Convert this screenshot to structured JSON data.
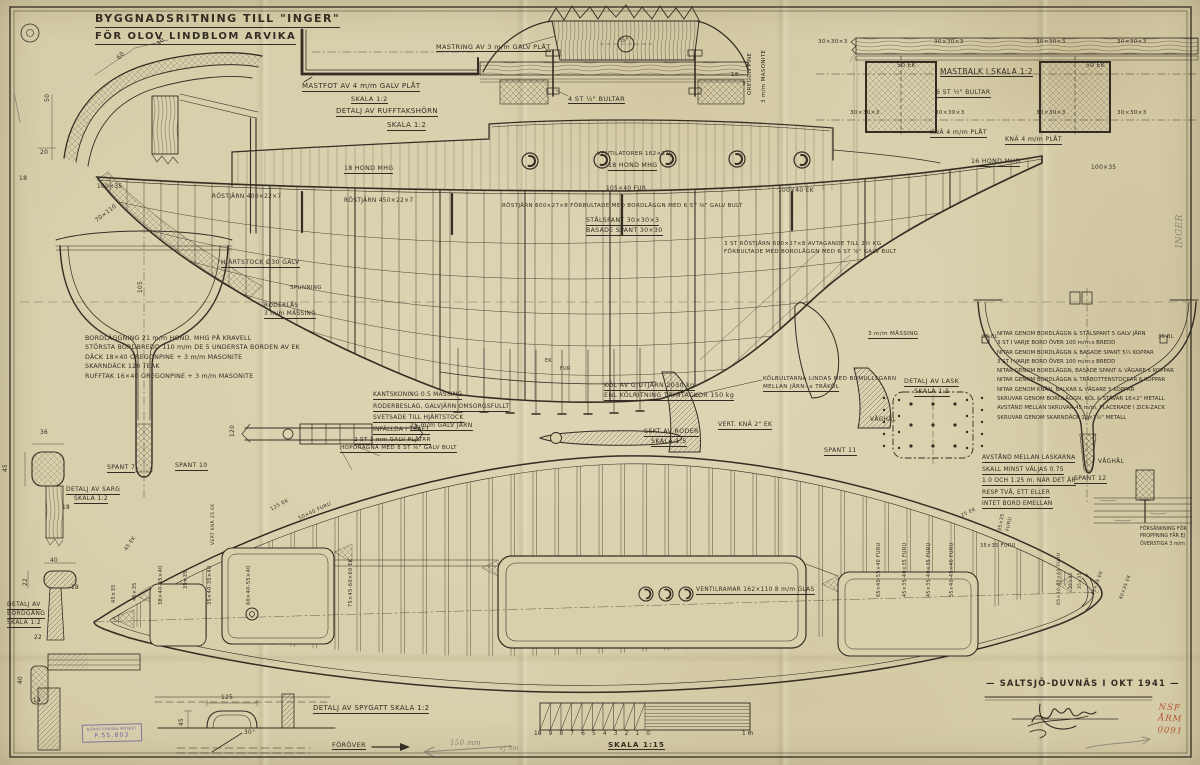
{
  "colors": {
    "paper": "#d6cda9",
    "ink": "#332d23",
    "pencil": "#8b8374",
    "stamp_purple": "#6f5b9e",
    "archive_red": "#b5502f"
  },
  "title": {
    "line1": "BYGGNADSRITNING TILL \"INGER\"",
    "line2": "FÖR OLOV LINDBLOM  ARVIKA"
  },
  "signature": {
    "place_date": "— SALTSJÖ-DUVNÄS I OKT 1941 —"
  },
  "scale_bar": {
    "numbers": [
      "10",
      "9",
      "8",
      "7",
      "6",
      "5",
      "4",
      "3",
      "2",
      "1",
      "0"
    ],
    "end_label": "1 m",
    "caption": "SKALA 1:15"
  },
  "stamps": {
    "museum_line1": "SJÖHISTORISKA MUSEET",
    "museum_line2": "P.55.803",
    "archive": [
      "NSF",
      "ÅRM",
      "0091"
    ]
  },
  "text_blocks": {
    "spec": [
      "BORDLÄGGNING   21 m/m HOND. MHG PÅ KRAVELL",
      "STÖRSTA BORDBREDD  110 m/m  DE 5 UNDERSTA BORDEN AV EK",
      "DÄCK  18×40 OREGONPINE + 3 m/m MASONITE",
      "SKARNDÄCK  120 TEAK",
      "RUFFTAK  16×40 OREGONPINE + 3 m/m MASONITE"
    ],
    "kantskoning": [
      "KANTSKONING 0.5 MÄSSING",
      "RODERBESLAG, GALVJÄRN OMSORGSFULLT",
      "SVETSADE TILL HJÄRTSTOCK",
      "INFÄLLDA I TRÄET"
    ],
    "nitar": [
      "NITAR GENOM BORDLÄGGN & STÅLSPANT  5 GALV JÄRN",
      "3 ST I VARJE BORD ÖVER 100 m/m:s BREDD",
      "NITAR GENOM BORDLÄGGN & BASADE SPANT  5½ KOPPAR",
      "3 ST I VARJE BORD ÖVER 100 m/m:s BREDD",
      "NITAR GENOM BORDLÄGGN, BASADE SPANT & VÄGARE  6 KOPPAR",
      "NITAR GENOM BORDLÄGGN & TRÄBOTTENSTOCKAR  6 KOPPAR",
      "NITAR GENOM KNÄN, BALKAR & VÄGARE  5 KOPPAR",
      "SKRUVAR GENOM BORDLÄGGN, KÖL & STÄVAR  16×2\" METALL",
      "AVSTÅND MELLAN SKRUVAR 45 m/m, PLACERADE I ZICK-ZACK",
      "SKRUVAR GENOM SKARNDÄCK  12×1½\" METALL"
    ],
    "lask_note": [
      "AVSTÅND MELLAN LASKARNA",
      "SKALL MINST VÄLJAS 0.75",
      "1.0 OCH 1.25 m. NÄR DET ÄR",
      "RESP TVÅ, ETT ELLER",
      "INTET BORD EMELLAN"
    ],
    "forsankning": [
      "FÖRSÄNKNING FÖR",
      "PROPPNING FÅR EJ",
      "ÖVERSTIGA 3 m/m"
    ]
  },
  "annotations": [
    {
      "t": "60",
      "x": 116,
      "y": 57,
      "r": -45,
      "fs": 6
    },
    {
      "t": "40",
      "x": 156,
      "y": 43,
      "r": -45,
      "fs": 6
    },
    {
      "t": "50",
      "x": 45,
      "y": 102,
      "r": -90,
      "fs": 6
    },
    {
      "t": "20",
      "x": 40,
      "y": 150,
      "fs": 6
    },
    {
      "t": "18",
      "x": 19,
      "y": 176,
      "fs": 6
    },
    {
      "t": "DETALJ AV RUFFTAKSHÖRN",
      "x": 336,
      "y": 108,
      "u": 1,
      "fs": 7
    },
    {
      "t": "SKALA 1:2",
      "x": 387,
      "y": 122,
      "u": 1,
      "fs": 7
    },
    {
      "t": "MASTFOT AV 4 m/m GALV PLÅT",
      "x": 302,
      "y": 83,
      "u": 1,
      "fs": 7
    },
    {
      "t": "SKALA 1:2",
      "x": 351,
      "y": 96,
      "u": 1,
      "fs": 6.5
    },
    {
      "t": "MASTRING AV 3 m/m GALV PLÅT",
      "x": 436,
      "y": 44,
      "u": 1,
      "fs": 6.5
    },
    {
      "t": "½\"",
      "x": 619,
      "y": 37,
      "fs": 6.5
    },
    {
      "t": "4 ST ½\" BULTAR",
      "x": 568,
      "y": 96,
      "u": 1,
      "fs": 6.5
    },
    {
      "t": "OREGON PINE",
      "x": 748,
      "y": 95,
      "r": -90,
      "fs": 5.5
    },
    {
      "t": "3 m/m MASONITE",
      "x": 762,
      "y": 103,
      "r": -90,
      "fs": 5.5
    },
    {
      "t": "18",
      "x": 731,
      "y": 73,
      "fs": 5.5
    },
    {
      "t": "3",
      "x": 742,
      "y": 82,
      "fs": 5.5
    },
    {
      "t": "30×30×3",
      "x": 818,
      "y": 40,
      "fs": 5.6
    },
    {
      "t": "30×30×3",
      "x": 934,
      "y": 40,
      "fs": 5.6
    },
    {
      "t": "30×30×3",
      "x": 1036,
      "y": 40,
      "fs": 5.6
    },
    {
      "t": "30×30×3",
      "x": 1117,
      "y": 40,
      "fs": 5.6
    },
    {
      "t": "30×30×3",
      "x": 850,
      "y": 111,
      "fs": 5.6
    },
    {
      "t": "30×30×3",
      "x": 935,
      "y": 111,
      "fs": 5.6
    },
    {
      "t": "30×30×3",
      "x": 1036,
      "y": 111,
      "fs": 5.6
    },
    {
      "t": "30×30×3",
      "x": 1117,
      "y": 111,
      "fs": 5.6
    },
    {
      "t": "50 EK",
      "x": 897,
      "y": 63,
      "fs": 6
    },
    {
      "t": "50 EK",
      "x": 1086,
      "y": 63,
      "fs": 6
    },
    {
      "t": "MASTBALK I SKALA 1:2",
      "x": 940,
      "y": 68,
      "u": 1,
      "fs": 7.5
    },
    {
      "t": "6 ST ½\" BULTAR",
      "x": 936,
      "y": 90,
      "u": 1,
      "fs": 6.2
    },
    {
      "t": "KNÄ 4 m/m PLÅT",
      "x": 930,
      "y": 130,
      "u": 1,
      "fs": 6.2
    },
    {
      "t": "KNÄ 4 m/m PLÅT",
      "x": 1005,
      "y": 137,
      "u": 1,
      "fs": 6.2
    },
    {
      "t": "VENTILATORER 162×110",
      "x": 597,
      "y": 152,
      "fs": 5.5
    },
    {
      "t": "18 HOND MHG",
      "x": 344,
      "y": 166,
      "u": 1,
      "fs": 6.2
    },
    {
      "t": "18 HOND MHG",
      "x": 608,
      "y": 163,
      "u": 1,
      "fs": 6.2
    },
    {
      "t": "16 HOND MHG",
      "x": 971,
      "y": 159,
      "u": 1,
      "fs": 6.2
    },
    {
      "t": "100×35",
      "x": 97,
      "y": 185,
      "fs": 5.8
    },
    {
      "t": "100×35",
      "x": 1091,
      "y": 166,
      "fs": 5.8
    },
    {
      "t": "70×110",
      "x": 95,
      "y": 220,
      "r": -38,
      "fs": 5.8
    },
    {
      "t": "RÖSTJÄRN 400×22×7",
      "x": 212,
      "y": 195,
      "fs": 5.8
    },
    {
      "t": "RÖSTJÄRN 450×22×7",
      "x": 344,
      "y": 199,
      "fs": 5.8
    },
    {
      "t": "RÖSTJÄRN 600×27×8 FÖRBULTADE MED BORDLÄGGN MED 6 ST ⅜\" GALV BULT",
      "x": 502,
      "y": 204,
      "fs": 5.5
    },
    {
      "t": "105×40 FUR",
      "x": 606,
      "y": 187,
      "fs": 5.8
    },
    {
      "t": "100×40 EK",
      "x": 778,
      "y": 189,
      "fs": 5.8
    },
    {
      "t": "STÅLSPANT 30×30×3",
      "x": 586,
      "y": 218,
      "u": 1,
      "fs": 6.2
    },
    {
      "t": "BASADE SPANT 30×30",
      "x": 586,
      "y": 228,
      "u": 1,
      "fs": 6.2
    },
    {
      "t": "3 ST RÖSTJÄRN 600×27×8 AVTAGANDE TILL 2½ KG",
      "x": 724,
      "y": 242,
      "fs": 5.5
    },
    {
      "t": "FÖRBULTADE MED BORDLÄGGN MED 6 ST ⅞\" GALV BULT",
      "x": 724,
      "y": 250,
      "fs": 5.5
    },
    {
      "t": "HJÄRTSTOCK Ø30 GALV",
      "x": 221,
      "y": 260,
      "u": 1,
      "fs": 6.2
    },
    {
      "t": "SPUNNING",
      "x": 290,
      "y": 286,
      "fs": 5.5
    },
    {
      "t": "RODERLÅS",
      "x": 264,
      "y": 304,
      "fs": 5.8
    },
    {
      "t": "3 m/m MÄSSING",
      "x": 264,
      "y": 312,
      "u": 1,
      "fs": 5.8
    },
    {
      "t": "25 m/m GALV JÄRN",
      "x": 410,
      "y": 423,
      "u": 1,
      "fs": 6
    },
    {
      "t": "120",
      "x": 231,
      "y": 437,
      "r": -90,
      "fs": 5.8
    },
    {
      "t": "2 ST 3 mm GALV PLÅTAR",
      "x": 354,
      "y": 438,
      "u": 1,
      "fs": 5.6
    },
    {
      "t": "HOPDRAGNA MED 8 ST ⅜\" GALV BULT",
      "x": 340,
      "y": 446,
      "u": 1,
      "fs": 5.6
    },
    {
      "t": "KÖL AV GJUTJÄRN  2030 kg",
      "x": 604,
      "y": 383,
      "u": 1,
      "fs": 6.3
    },
    {
      "t": "ENL KÖLRITNING  TRIMTACKOR 150 kg",
      "x": 604,
      "y": 393,
      "u": 1,
      "fs": 6.3
    },
    {
      "t": "SEKT AV RODER",
      "x": 644,
      "y": 429,
      "u": 1,
      "fs": 6.3
    },
    {
      "t": "SKALA 1:5",
      "x": 651,
      "y": 439,
      "u": 1,
      "fs": 6.3
    },
    {
      "t": "KÖLBULTARNA LINDAS MED BOMULLSGARN",
      "x": 763,
      "y": 377,
      "fs": 5.6
    },
    {
      "t": "MELLAN JÄRN- o TRÄKÖL",
      "x": 763,
      "y": 385,
      "u": 1,
      "fs": 5.6
    },
    {
      "t": "VERT. KNÄ 2\" EK",
      "x": 718,
      "y": 422,
      "u": 1,
      "fs": 6
    },
    {
      "t": "VÅGHÅL",
      "x": 870,
      "y": 418,
      "fs": 5.8
    },
    {
      "t": "VÅGHÅL",
      "x": 1098,
      "y": 460,
      "fs": 5.8
    },
    {
      "t": "SPANT 11",
      "x": 824,
      "y": 448,
      "u": 1,
      "fs": 6.2
    },
    {
      "t": "SPANT 12",
      "x": 1074,
      "y": 476,
      "u": 1,
      "fs": 6.2
    },
    {
      "t": "3 m/m MÄSSING",
      "x": 868,
      "y": 332,
      "u": 1,
      "fs": 5.6
    },
    {
      "t": "DETALJ AV LASK",
      "x": 904,
      "y": 379,
      "u": 1,
      "fs": 6.3
    },
    {
      "t": "SKALA 1:5",
      "x": 914,
      "y": 389,
      "u": 1,
      "fs": 6.3
    },
    {
      "t": "35 BL",
      "x": 982,
      "y": 335,
      "fs": 5
    },
    {
      "t": "35 BL",
      "x": 1158,
      "y": 335,
      "fs": 5
    },
    {
      "t": "SPANT 7",
      "x": 107,
      "y": 465,
      "u": 1,
      "fs": 6.2
    },
    {
      "t": "SPANT 10",
      "x": 175,
      "y": 463,
      "u": 1,
      "fs": 6.2
    },
    {
      "t": "105",
      "x": 139,
      "y": 293,
      "r": -90,
      "fs": 5.8
    },
    {
      "t": "36",
      "x": 40,
      "y": 431,
      "fs": 5.8
    },
    {
      "t": "45",
      "x": 4,
      "y": 472,
      "r": -90,
      "fs": 5.8
    },
    {
      "t": "18",
      "x": 62,
      "y": 506,
      "fs": 5.8
    },
    {
      "t": "DETALJ AV SARG",
      "x": 66,
      "y": 487,
      "u": 1,
      "fs": 6
    },
    {
      "t": "SKALA 1:2",
      "x": 74,
      "y": 496,
      "u": 1,
      "fs": 6
    },
    {
      "t": "40",
      "x": 50,
      "y": 559,
      "fs": 5.8
    },
    {
      "t": "22",
      "x": 24,
      "y": 586,
      "r": -90,
      "fs": 5.8
    },
    {
      "t": "18",
      "x": 71,
      "y": 586,
      "fs": 5.8
    },
    {
      "t": "DETALJ AV",
      "x": 7,
      "y": 602,
      "u": 1,
      "fs": 6
    },
    {
      "t": "BORDGÅNG",
      "x": 7,
      "y": 611,
      "u": 1,
      "fs": 6
    },
    {
      "t": "SKALA 1:2",
      "x": 7,
      "y": 620,
      "u": 1,
      "fs": 6
    },
    {
      "t": "22",
      "x": 34,
      "y": 636,
      "fs": 5.8
    },
    {
      "t": "40",
      "x": 19,
      "y": 684,
      "r": -90,
      "fs": 5.8
    },
    {
      "t": "14",
      "x": 33,
      "y": 699,
      "fs": 5.8
    },
    {
      "t": "45×35",
      "x": 112,
      "y": 603,
      "r": -90,
      "fs": 5
    },
    {
      "t": "45×35",
      "x": 133,
      "y": 601,
      "r": -90,
      "fs": 5
    },
    {
      "t": "45 EK",
      "x": 124,
      "y": 549,
      "r": -55,
      "fs": 5
    },
    {
      "t": "38×40-45×40",
      "x": 159,
      "y": 605,
      "r": -90,
      "fs": 5
    },
    {
      "t": "35×35",
      "x": 184,
      "y": 589,
      "r": -90,
      "fs": 5
    },
    {
      "t": "35×40-35×40",
      "x": 208,
      "y": 605,
      "r": -90,
      "fs": 5
    },
    {
      "t": "VERT KNÄ 25 EK",
      "x": 212,
      "y": 545,
      "r": -90,
      "fs": 4.5
    },
    {
      "t": "60×40-55×40",
      "x": 247,
      "y": 605,
      "r": -90,
      "fs": 5
    },
    {
      "t": "125 EK",
      "x": 270,
      "y": 508,
      "r": -28,
      "fs": 5
    },
    {
      "t": "50×40 FURU",
      "x": 298,
      "y": 517,
      "r": -25,
      "fs": 5
    },
    {
      "t": "75×45-60×60 EK",
      "x": 349,
      "y": 607,
      "r": -90,
      "fs": 5
    },
    {
      "t": "65×40-55×40 FURU",
      "x": 878,
      "y": 597,
      "r": -90,
      "fs": 4.8
    },
    {
      "t": "45×35-40×35 FURU",
      "x": 904,
      "y": 597,
      "r": -90,
      "fs": 4.8
    },
    {
      "t": "45×35-40×35 FURU",
      "x": 928,
      "y": 597,
      "r": -90,
      "fs": 4.8
    },
    {
      "t": "55×40-45×40 FURU",
      "x": 951,
      "y": 597,
      "r": -90,
      "fs": 4.8
    },
    {
      "t": "25 EK",
      "x": 961,
      "y": 515,
      "r": -25,
      "fs": 4.8
    },
    {
      "t": "35×35",
      "x": 999,
      "y": 531,
      "r": -80,
      "fs": 4.8
    },
    {
      "t": "FURU",
      "x": 1007,
      "y": 531,
      "r": -80,
      "fs": 4.8
    },
    {
      "t": "35×35  FURU",
      "x": 980,
      "y": 544,
      "fs": 5
    },
    {
      "t": "65×40-45×40 FURU",
      "x": 1058,
      "y": 605,
      "r": -90,
      "fs": 4.6
    },
    {
      "t": "35×35",
      "x": 1070,
      "y": 589,
      "r": -90,
      "fs": 4.4
    },
    {
      "t": "35×35",
      "x": 1079,
      "y": 589,
      "r": -90,
      "fs": 4.4
    },
    {
      "t": "45×35 EK",
      "x": 1092,
      "y": 595,
      "r": -70,
      "fs": 4.6
    },
    {
      "t": "40×35 EK",
      "x": 1120,
      "y": 599,
      "r": -70,
      "fs": 4.6
    },
    {
      "t": "VENTILRAMAR 162×110 8 m/m GLAS",
      "x": 696,
      "y": 588,
      "u": 1,
      "fs": 5.8
    },
    {
      "t": "DETALJ AV SPYGATT  SKALA 1:2",
      "x": 313,
      "y": 705,
      "u": 1,
      "fs": 7
    },
    {
      "t": "125",
      "x": 221,
      "y": 696,
      "fs": 5.8
    },
    {
      "t": "45",
      "x": 180,
      "y": 726,
      "r": -90,
      "fs": 5.8
    },
    {
      "t": "30°",
      "x": 244,
      "y": 731,
      "fs": 5.8
    },
    {
      "t": "FÖRÖVER",
      "x": 332,
      "y": 742,
      "u": 1,
      "fs": 6.5
    },
    {
      "t": "EK",
      "x": 545,
      "y": 360,
      "fs": 4.8
    },
    {
      "t": "FUR",
      "x": 560,
      "y": 368,
      "fs": 4.8
    },
    {
      "t": "150 mm",
      "x": 450,
      "y": 740,
      "fs": 7,
      "c": "pencil",
      "i": 1
    },
    {
      "t": "ej hm",
      "x": 500,
      "y": 746,
      "fs": 6,
      "c": "pencil",
      "i": 1
    },
    {
      "t": "INGER",
      "x": 1176,
      "y": 248,
      "r": -90,
      "fs": 9,
      "c": "pencil",
      "i": 1
    }
  ]
}
